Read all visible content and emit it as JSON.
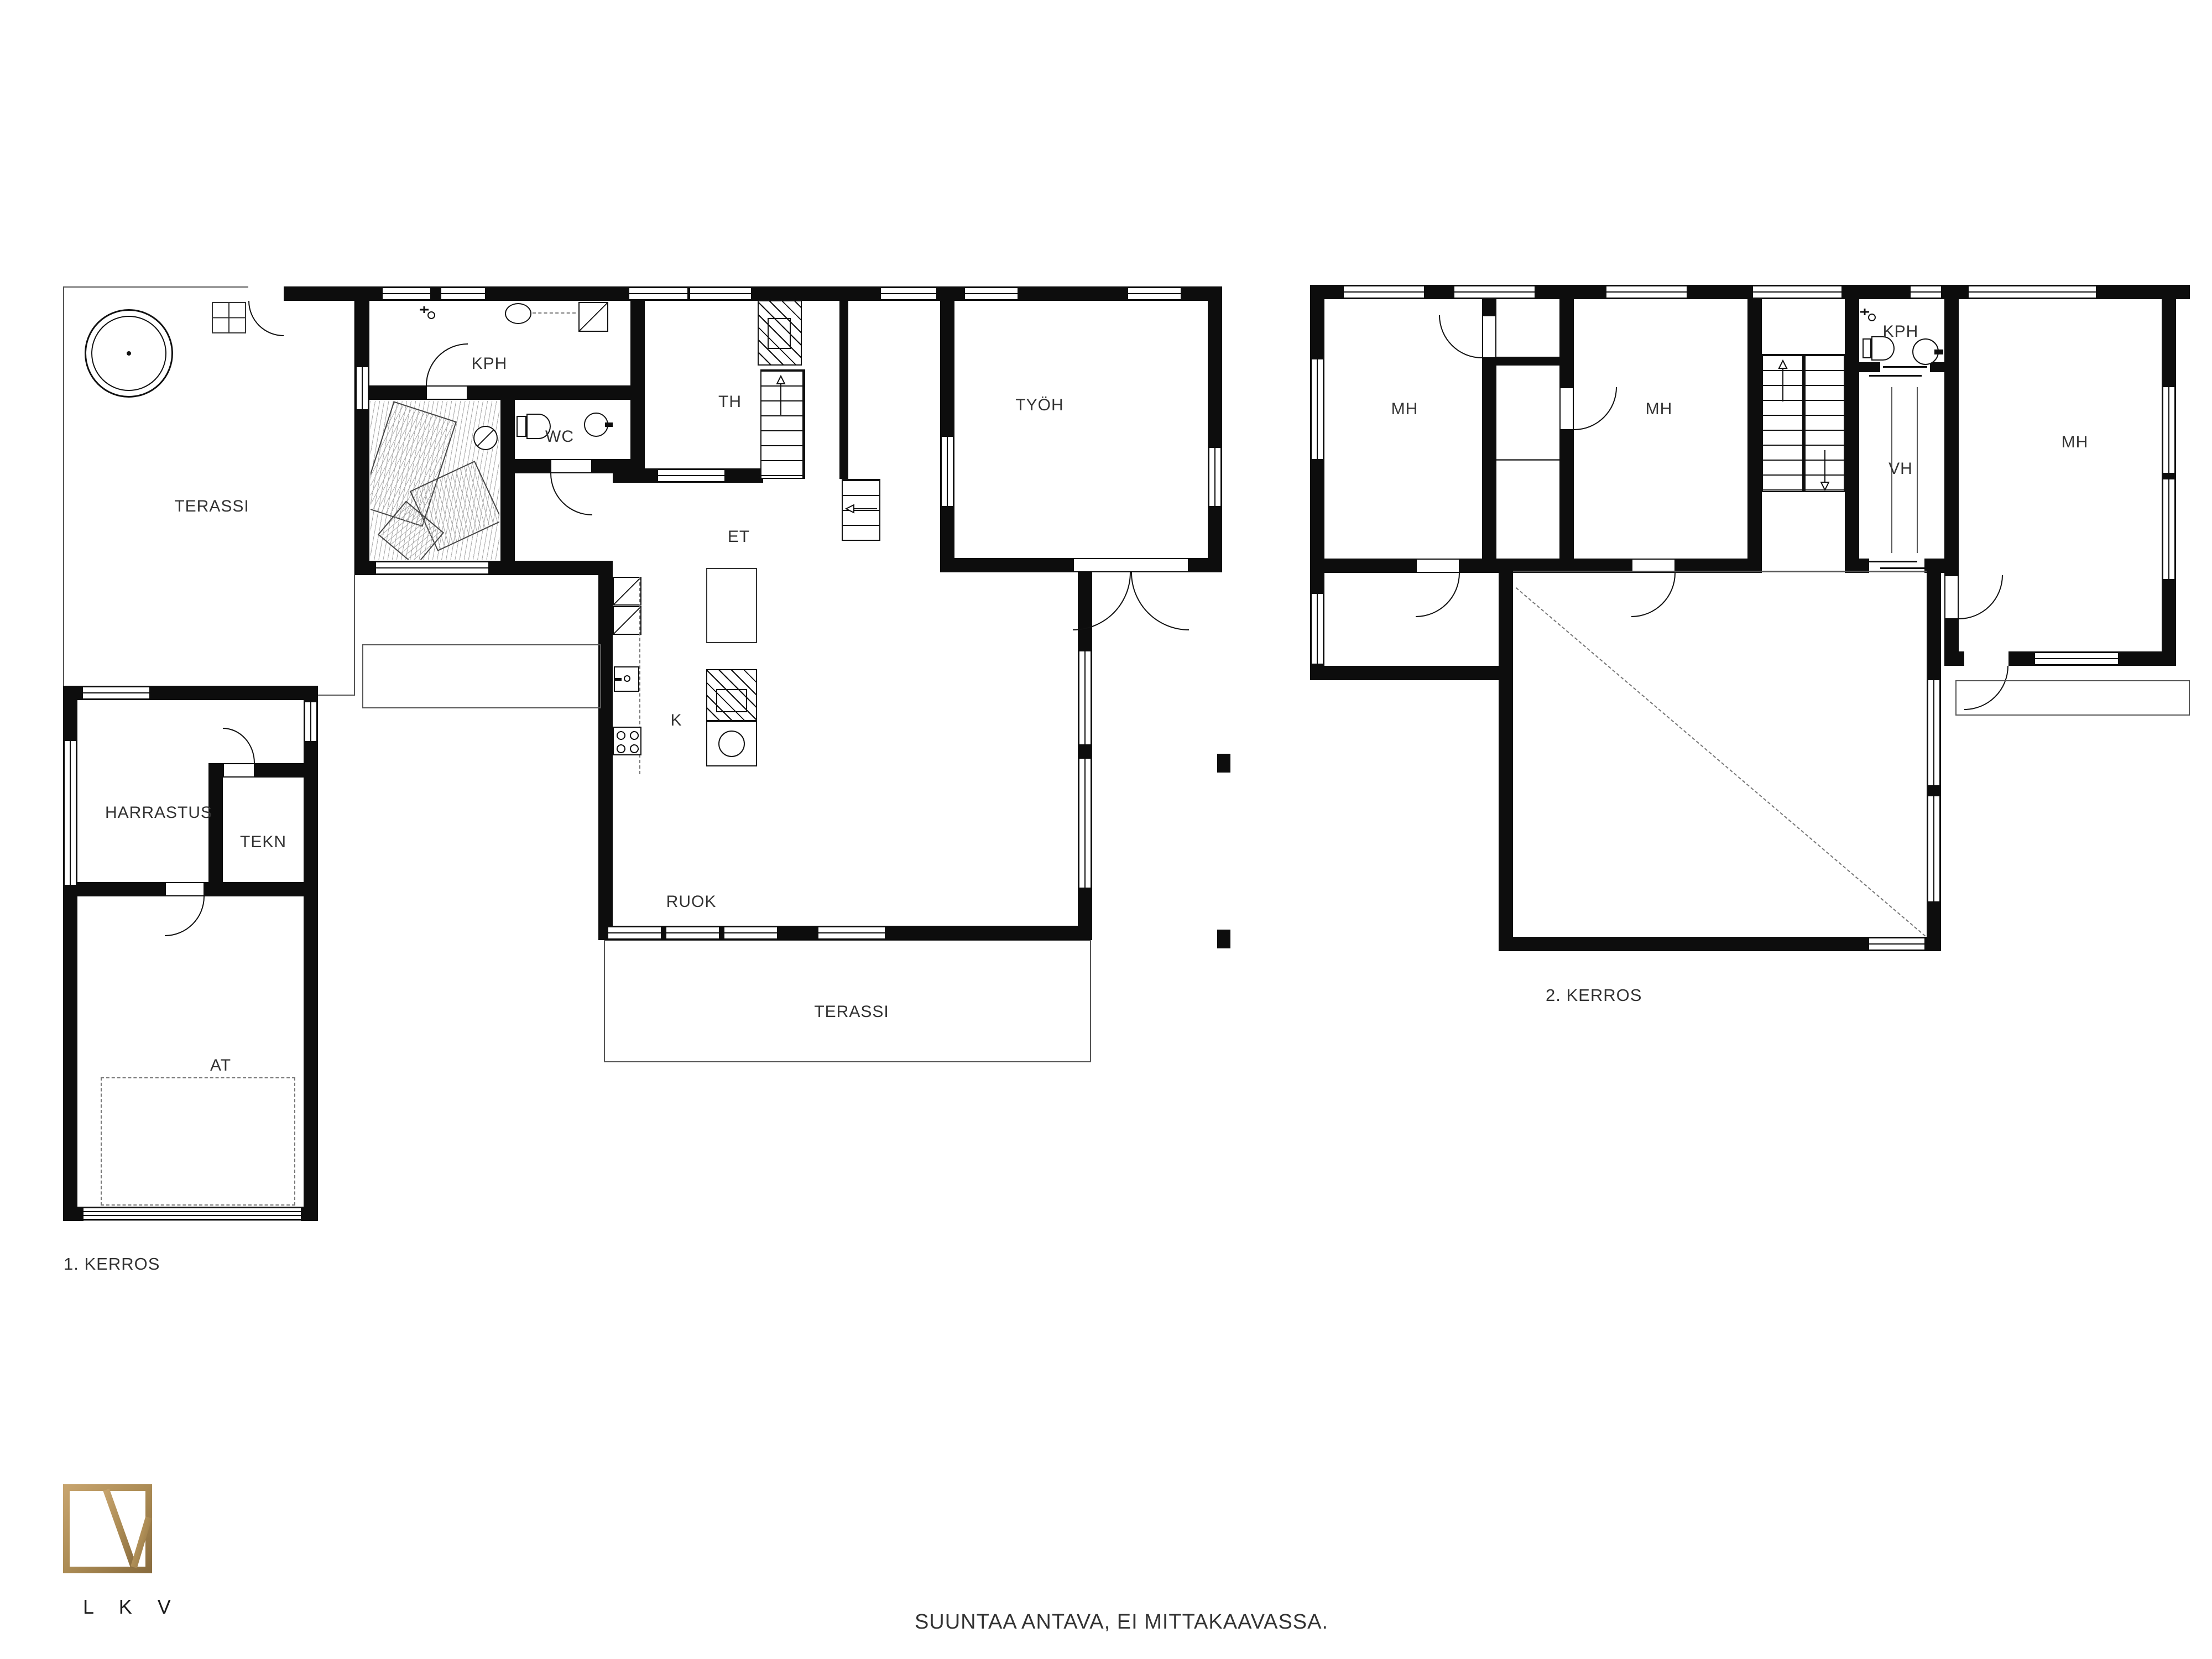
{
  "document": {
    "type": "floor-plan",
    "floor_count": 2
  },
  "labels": {
    "terassi_upper": "TERASSI",
    "kph_floor1": "KPH",
    "wc": "WC",
    "th": "TH",
    "tyoh": "TYÖH",
    "et": "ET",
    "kitchen": "K",
    "ruok": "RUOK",
    "terassi_lower": "TERASSI",
    "harrastus": "HARRASTUS",
    "tekn": "TEKN",
    "at": "AT",
    "floor1_caption": "1. KERROS",
    "mh_left": "MH",
    "mh_middle": "MH",
    "kph_floor2": "KPH",
    "vh": "VH",
    "mh_right": "MH",
    "floor2_caption": "2. KERROS"
  },
  "floors": [
    {
      "name": "1. KERROS",
      "rooms": [
        "TERASSI",
        "KPH",
        "WC",
        "TH",
        "TYÖH",
        "ET",
        "K",
        "RUOK",
        "TERASSI",
        "HARRASTUS",
        "TEKN",
        "AT"
      ]
    },
    {
      "name": "2. KERROS",
      "rooms": [
        "MH",
        "MH",
        "KPH",
        "VH",
        "MH"
      ]
    }
  ],
  "footer": {
    "note": "SUUNTAA ANTAVA, EI MITTAKAAVASSA."
  },
  "logo": {
    "text": "L K V",
    "icon": "lkv-frame-logo-icon",
    "color": "#ab8b54"
  },
  "colors": {
    "background": "#ffffff",
    "walls": "#0d0d0d",
    "thin_lines": "#555555",
    "text": "#333333",
    "logo_gold": "#ab8b54"
  },
  "icons": [
    "hot-tub-icon",
    "patio-grid-icon",
    "sauna-stove-icon",
    "fireplace-icon",
    "toilet-icon",
    "washbasin-icon",
    "round-sink-icon",
    "shower-head-icon",
    "shower-cabin-icon",
    "fridge-icon",
    "freezer-icon",
    "cooktop-icon",
    "kitchen-sink-icon",
    "stairs-up-arrow-icon",
    "stairs-down-arrow-icon",
    "stairs-left-arrow-icon",
    "garage-door-icon",
    "lkv-frame-logo-icon"
  ]
}
